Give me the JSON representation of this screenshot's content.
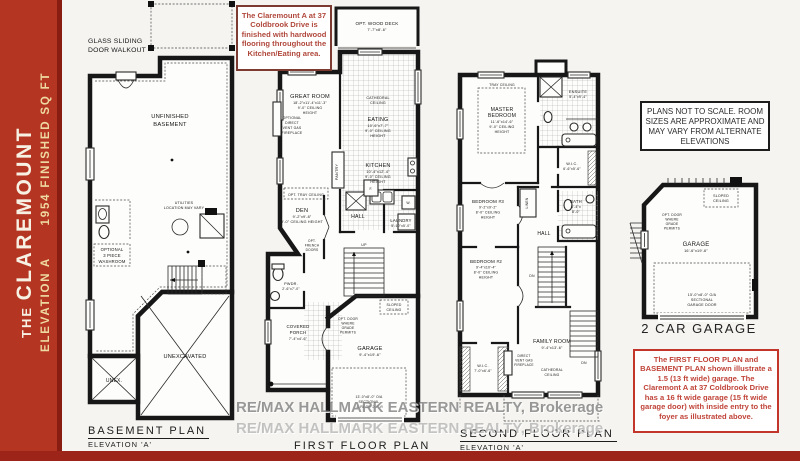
{
  "sidebar": {
    "prefix": "THE",
    "name": "CLAREMOUNT",
    "elevation": "ELEVATION A",
    "sqft": "1954 FINISHED SQ FT",
    "bg_color": "#b43522",
    "accent_text_color": "#eed9a0"
  },
  "notes": {
    "hardwood": "The Claremount A at 37 Coldbrook Drive is finished with hardwood flooring throughout the Kitchen/Eating area.",
    "scale": "PLANS NOT TO SCALE.  ROOM SIZES ARE APPROXIMATE AND MAY VARY FROM ALTERNATE ELEVATIONS",
    "garage": "The FIRST FLOOR PLAN and BASEMENT PLAN shown illustrate a 1.5 (13 ft wide) garage.  The Claremont A at 37 Coldbrook Drive has a 16 ft wide garage (15 ft wide garage door) with inside entry to the foyer as illustrated above."
  },
  "watermark": {
    "line1": "RE/MAX HALLMARK EASTERN REALTY, Brokerage",
    "line2": "RE/MAX HALLMARK EASTERN REALTY, Brokerage"
  },
  "basement": {
    "title": "BASEMENT PLAN",
    "elevation": "ELEVATION 'A'",
    "walkout": [
      "GLASS SLIDING",
      "DOOR WALKOUT"
    ],
    "unfinished": [
      "UNFINISHED",
      "BASEMENT"
    ],
    "utilities": [
      "UTILITIES",
      "LOCATION MAY VARY"
    ],
    "washroom": [
      "OPTIONAL",
      "3 PIECE",
      "WASHROOM"
    ],
    "unexcavated": "UNEXCAVATED",
    "unex": "UNEX."
  },
  "first": {
    "title": "FIRST FLOOR PLAN",
    "elevation": "ELEVATION 'A'",
    "deck": [
      "OPT. WOOD DECK",
      "7'-7\"x8'-6\""
    ],
    "cathedral": [
      "CATHEDRAL",
      "CEILING"
    ],
    "eating": [
      "EATING",
      "10'-6\"x7'-7\"",
      "9'-0\" CEILING",
      "HEIGHT"
    ],
    "great_room": [
      "GREAT ROOM",
      "18'-2\"x11'-4\"x11'-3\"",
      "9'-0\" CEILING",
      "HEIGHT"
    ],
    "fireplace": [
      "OPTIONAL",
      "DIRECT",
      "VENT GAS",
      "FIREPLACE"
    ],
    "kitchen": [
      "KITCHEN",
      "10'-4\"x12'-4\"",
      "9'-0\" CEILING",
      "HEIGHT"
    ],
    "pantry": "PANTRY",
    "tray": "OPT. TRAY CEILING",
    "den": [
      "DEN",
      "9'-2\"x9'-8\"",
      "9'-0\" CEILING HEIGHT"
    ],
    "french": [
      "OPT.",
      "FRENCH",
      "DOORS"
    ],
    "hall": "HALL",
    "laundry": [
      "LAUNDRY",
      "5'-10\"x5'-0\""
    ],
    "furnace": "F.",
    "washer": "W.",
    "up": "UP",
    "pwdr": [
      "PWDR.",
      "2'-6\"x7'-0\""
    ],
    "opt_door": [
      "OPT. DOOR",
      "WHERE",
      "GRADE",
      "PERMITS"
    ],
    "sloped": [
      "SLOPED",
      "CEILING"
    ],
    "garage": [
      "GARAGE",
      "9'-4\"x19'-6\""
    ],
    "garage_door": [
      "13'-0\"x8'-0\" O/A",
      "SECTIONAL",
      "GARAGE DOOR"
    ],
    "porch": [
      "COVERED",
      "PORCH",
      "7'-4\"x4'-6\""
    ]
  },
  "second": {
    "title": "SECOND FLOOR PLAN",
    "elevation": "ELEVATION 'A'",
    "tray": "TRAY CEILING",
    "master": [
      "MASTER",
      "BEDROOM",
      "11'-6\"x14'-6\"",
      "9'-0\" CEILING",
      "HEIGHT"
    ],
    "ensuite": [
      "ENSUITE",
      "5'-4\"x9'-4\""
    ],
    "wic1": [
      "W.I.C.",
      "6'-6\"x5'-6\""
    ],
    "bedroom3": [
      "BEDROOM #3",
      "9'-2\"x9'-2\"",
      "8'-0\" CEILING",
      "HEIGHT"
    ],
    "linen": "LINEN",
    "hall": "HALL",
    "bath": [
      "BATH",
      "5'-4\"x",
      "8'-0\""
    ],
    "bedroom2": [
      "BEDROOM #2",
      "9'-4\"x10'-4\"",
      "8'-0\" CEILING",
      "HEIGHT"
    ],
    "dn1": "DN",
    "dn2": "DN",
    "wic2": [
      "W.I.C.",
      "7'-0\"x6'-6\""
    ],
    "family": [
      "FAMILY ROOM",
      "9'-4\"x13'-6\""
    ],
    "fireplace": [
      "DIRECT",
      "VENT GAS",
      "FIREPLACE"
    ],
    "cathedral": [
      "CATHEDRAL",
      "CEILING"
    ]
  },
  "garage_plan": {
    "title": "2 CAR GARAGE",
    "sloped": [
      "SLOPED",
      "CEILING"
    ],
    "opt_door": [
      "OPT. DOOR",
      "WHERE",
      "GRADE",
      "PERMITS"
    ],
    "garage": [
      "GARAGE",
      "16'-6\"x19'-6\""
    ],
    "door": [
      "15'-0\"x8'-0\" O/A",
      "SECTIONAL",
      "GARAGE DOOR"
    ]
  }
}
